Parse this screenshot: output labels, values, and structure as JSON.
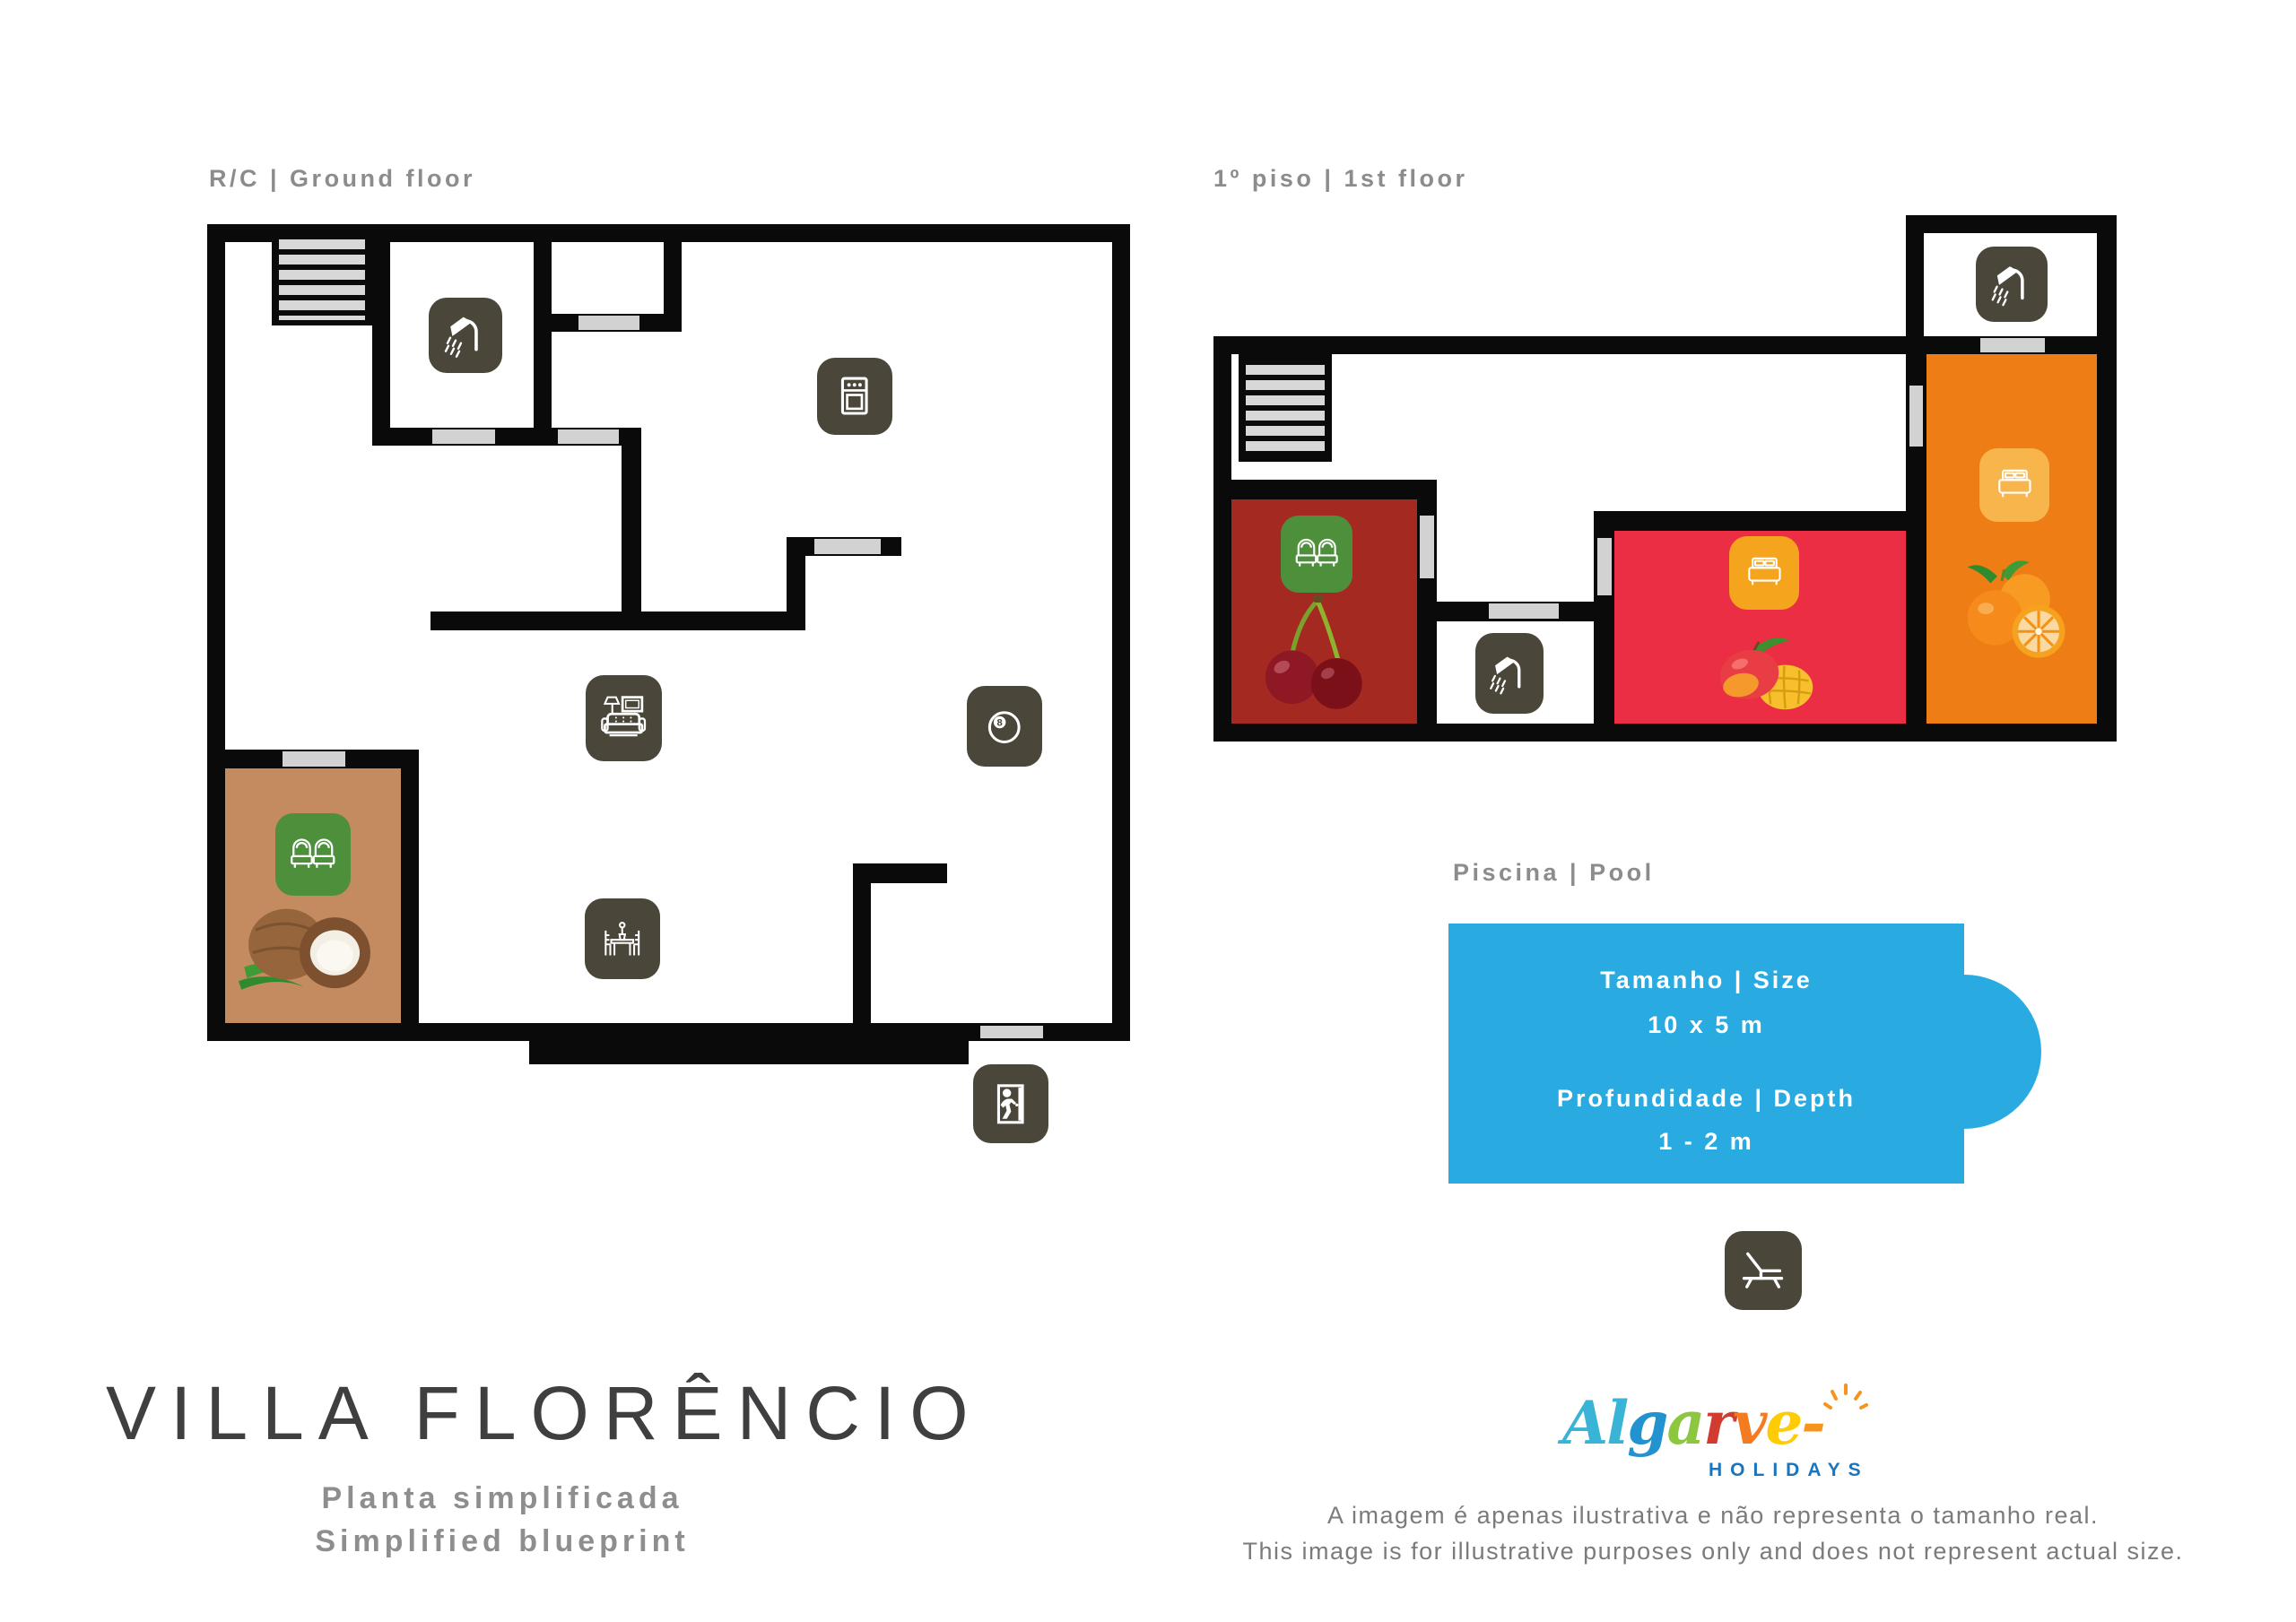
{
  "floors": {
    "ground": {
      "label": "R/C | Ground floor"
    },
    "first": {
      "label": "1º piso | 1st floor"
    }
  },
  "pool": {
    "label": "Piscina | Pool",
    "size_label": "Tamanho | Size",
    "size_value": "10 x 5 m",
    "depth_label": "Profundidade | Depth",
    "depth_value": "1 - 2 m"
  },
  "footer": {
    "title": "VILLA FLORÊNCIO",
    "subtitle_pt": "Planta simplificada",
    "subtitle_en": "Simplified blueprint",
    "disclaimer_pt": "A imagem é apenas ilustrativa e não representa o tamanho real.",
    "disclaimer_en": "This image is for illustrative purposes only and does not represent actual size."
  },
  "logo": {
    "letters": [
      {
        "ch": "A",
        "style": "color:#39b4d6"
      },
      {
        "ch": "l",
        "style": "color:#39b4d6"
      },
      {
        "ch": "g",
        "style": "color:#2293cf"
      },
      {
        "ch": "a",
        "style": "color:#8dc63f"
      },
      {
        "ch": "r",
        "style": "color:#d13b30"
      },
      {
        "ch": "v",
        "style": "color:#f47b20"
      },
      {
        "ch": "e",
        "style": "color:#ffcb05"
      },
      {
        "ch": "-",
        "style": "color:#f7941d"
      }
    ],
    "suffix": "HOLIDAYS",
    "suffix_style": "color:#1b75bc"
  },
  "icons": {
    "billiards_digit": "8",
    "names": [
      "shower-icon",
      "oven-icon",
      "sofa-tv-icon",
      "billiards-icon",
      "twin-beds-icon",
      "double-bed-icon",
      "dining-table-icon",
      "exit-icon",
      "sun-lounger-icon",
      "stairs",
      "cherries-image",
      "coconut-image",
      "mango-image",
      "oranges-image"
    ]
  },
  "colors": {
    "wall": "#0a0a0a",
    "door_opening": "#d2d2d2",
    "icon_dark": "#4a4639",
    "icon_green": "#4e8f3c",
    "icon_orange": "#f5a41e",
    "icon_light_orange": "#f8b54b",
    "room_coconut": "#c48a60",
    "room_cherry": "#a42a21",
    "room_mango": "#eb2e44",
    "room_orange": "#ee7d15",
    "pool_blue": "#29abe2",
    "label_gray": "#8c8c8c",
    "logo_holidays_blue": "#1b75bc"
  }
}
